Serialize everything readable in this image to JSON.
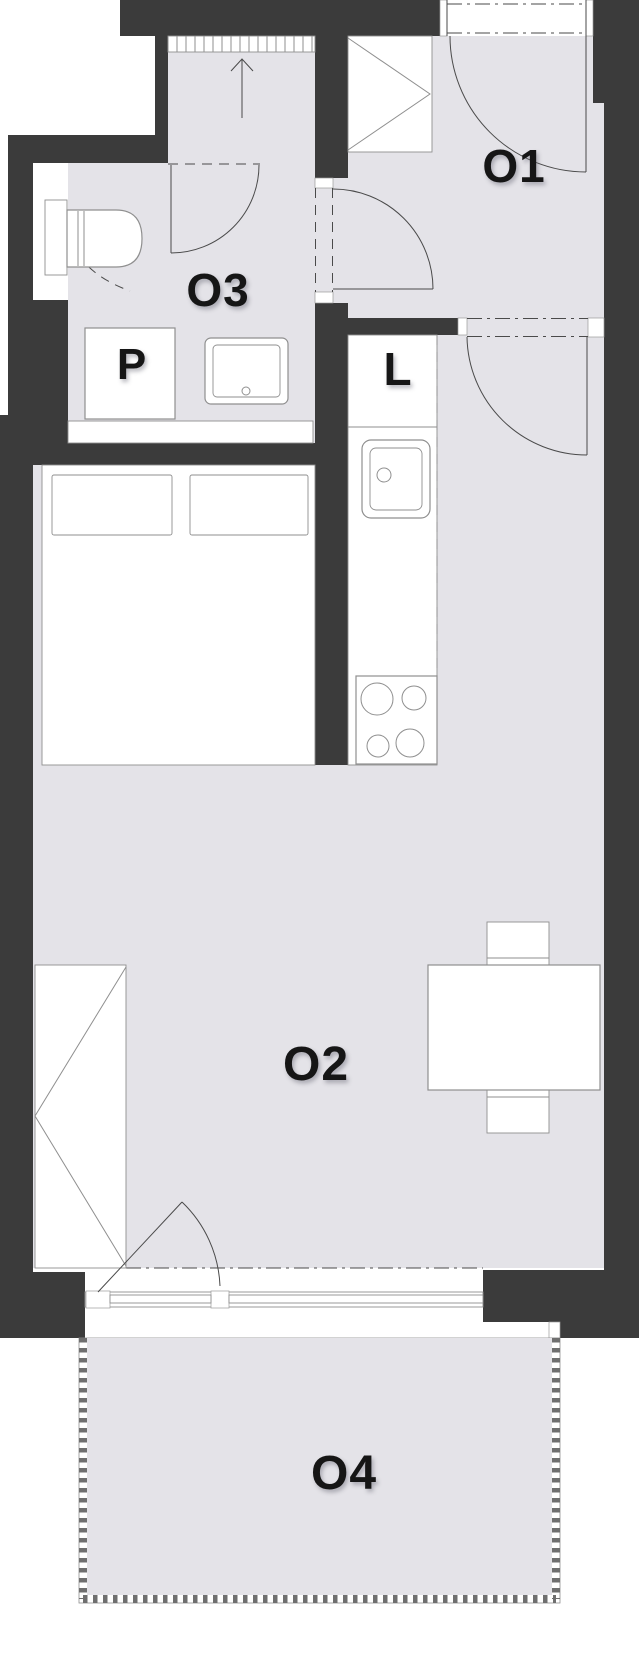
{
  "plan": {
    "labels": {
      "room1": "O1",
      "room2": "O2",
      "room3": "O3",
      "terrace": "O4",
      "washer": "P",
      "fridge": "L"
    },
    "colors": {
      "wall": "#3b3b3b",
      "floor": "#e4e3e8",
      "line": "#4a4a4a",
      "furnitureStroke": "#8f8f8f",
      "railing": "#6f6f6f"
    }
  }
}
